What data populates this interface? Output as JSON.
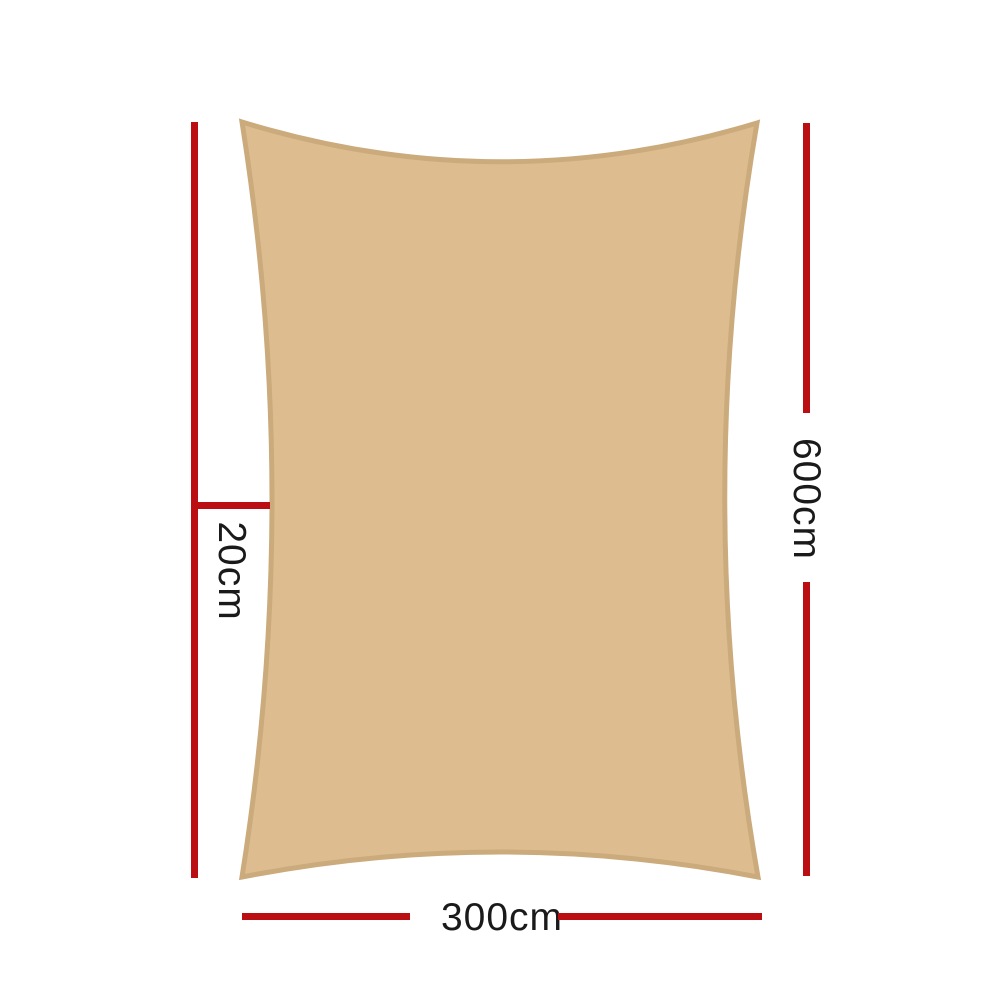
{
  "diagram": {
    "labels": {
      "height": "600cm",
      "width": "300cm",
      "curve_depth": "20cm"
    }
  },
  "colors": {
    "background": "#ffffff",
    "dimension_line": "#bb0e13",
    "label_text": "#1a1a1a",
    "sail_fill": "#ddbd90",
    "sail_border": "#cbaa7c"
  }
}
